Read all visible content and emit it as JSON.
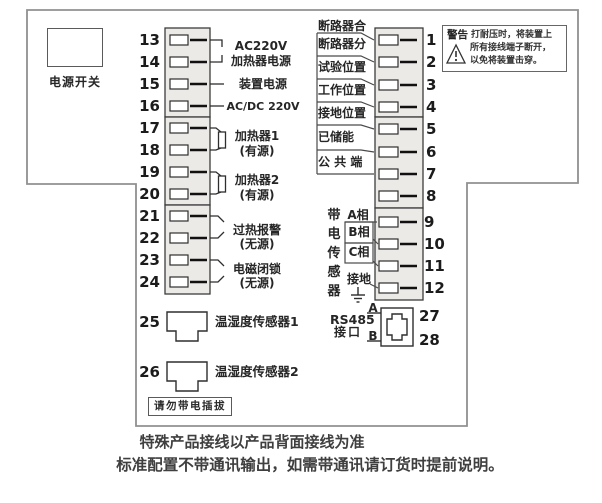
{
  "colors": {
    "wiring_line": "#2e2e2e",
    "outline": "#909090",
    "strip_fill": "#eceae6",
    "text": "#262626"
  },
  "power_switch": {
    "label": "电源开关"
  },
  "left_block": {
    "terminals": [
      "13",
      "14",
      "15",
      "16",
      "17",
      "18",
      "19",
      "20",
      "21",
      "22",
      "23",
      "24"
    ],
    "labels": [
      {
        "line1": "AC220V",
        "line2": "加热器电源"
      },
      {
        "line1": "装置电源",
        "line2": "AC/DC 220V"
      },
      {
        "line1": "加热器1",
        "line2": "(有源)"
      },
      {
        "line1": "加热器2",
        "line2": "(有源)"
      },
      {
        "line1": "过热报警",
        "line2": "(无源)"
      },
      {
        "line1": "电磁闭锁",
        "line2": "(无源)"
      }
    ],
    "sensor1_num": "25",
    "sensor1_label": "温湿度传感器1",
    "sensor2_num": "26",
    "sensor2_label": "温湿度传感器2",
    "no_hotplug": "请勿带电插拔"
  },
  "right_block": {
    "terminals": [
      "1",
      "2",
      "3",
      "4",
      "5",
      "6",
      "7",
      "8",
      "9",
      "10",
      "11",
      "12"
    ],
    "labels": [
      "断路器合",
      "断路器分",
      "试验位置",
      "工作位置",
      "接地位置",
      "已储能",
      "公 共 端"
    ],
    "sensor_title": "带电传感器",
    "phases": [
      "A相",
      "B相",
      "C相",
      "接地"
    ],
    "rs485": {
      "line1": "RS485",
      "line2": "接口",
      "a": "A",
      "b": "B",
      "t27": "27",
      "t28": "28"
    }
  },
  "warning": {
    "title": "警告",
    "line1": "打耐压时，将装置上",
    "line2": "所有接线端子断开，",
    "line3": "以免将装置击穿。"
  },
  "footer": {
    "line1": "特殊产品接线以产品背面接线为准",
    "line2": "标准配置不带通讯输出，如需带通讯请订货时提前说明。"
  }
}
